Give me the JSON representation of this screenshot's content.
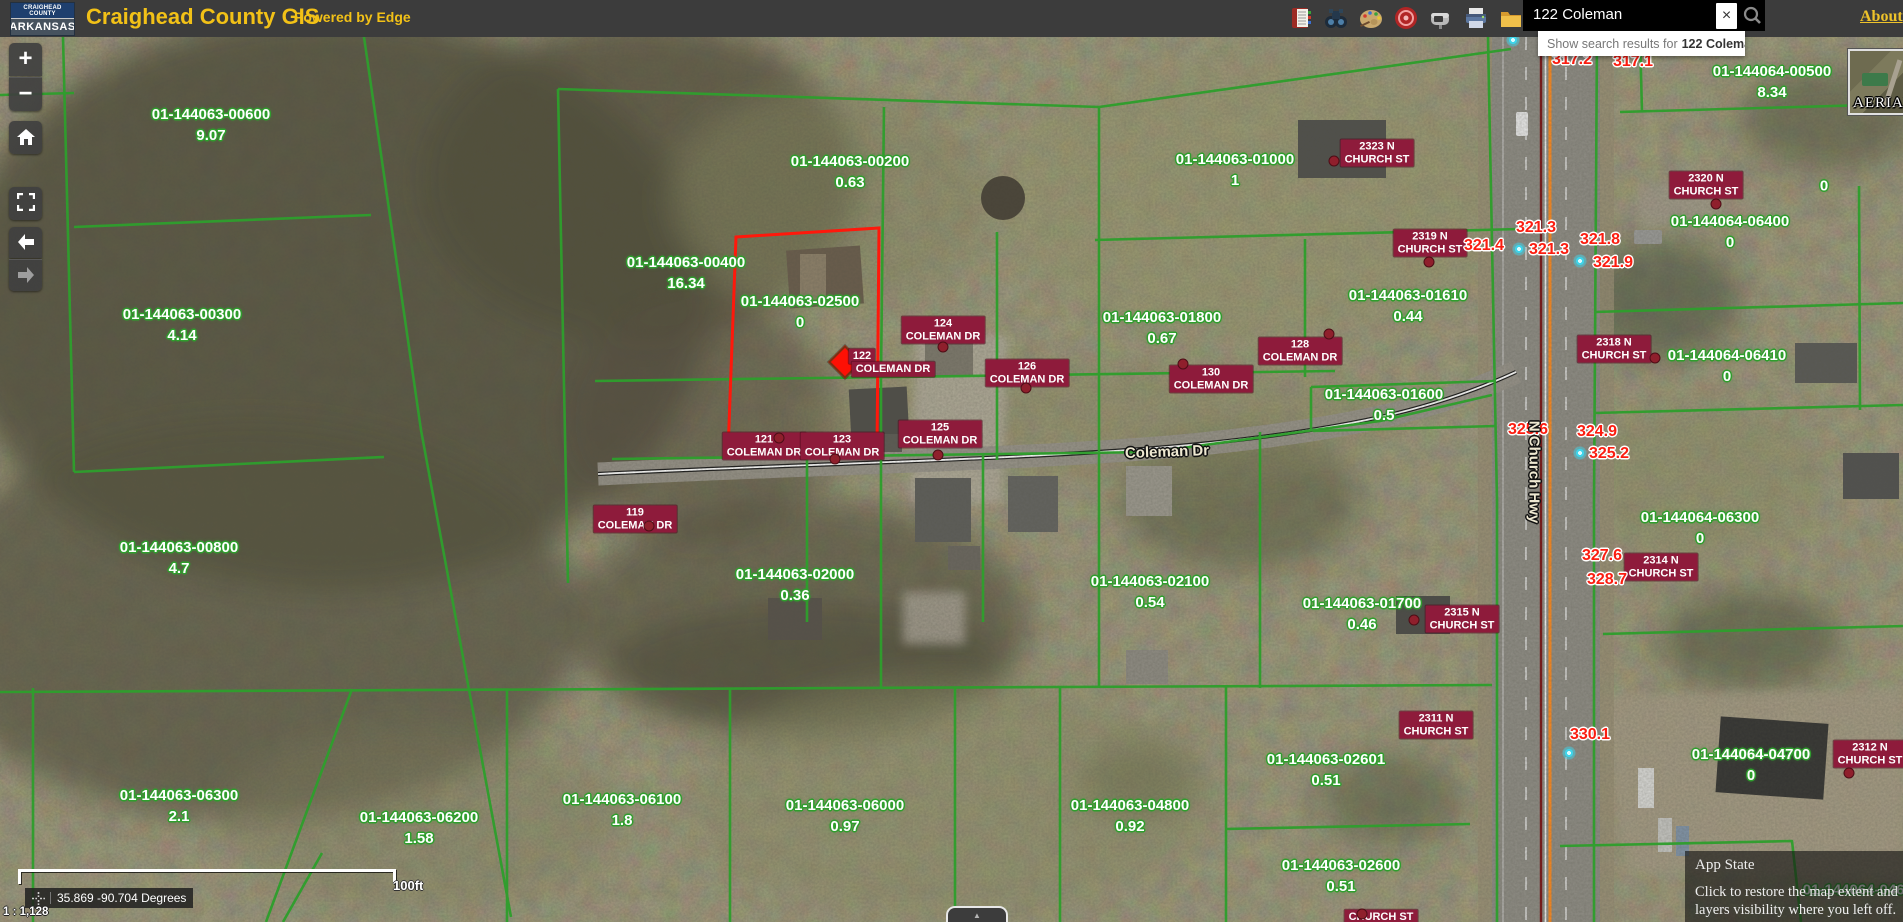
{
  "header": {
    "logo_line1": "CRAIGHEAD COUNTY",
    "logo_line2": "ARKANSAS",
    "title": "Craighead County GIS",
    "powered_by": "Powered by Edge",
    "about_link": "About",
    "toolbar_icons": [
      "address-book",
      "binoculars",
      "palette",
      "target",
      "mailbox",
      "printer",
      "folder"
    ],
    "search": {
      "value": "122 Coleman",
      "clear_label": "×",
      "suggestion_prefix": "Show search results for",
      "suggestion_query": "122 Coleman"
    }
  },
  "controls": {
    "zoom_in": "+",
    "zoom_out": "−"
  },
  "statusbar": {
    "scale_label": "100ft",
    "coordinates": "35.869 -90.704 Degrees",
    "scale_ratio": "1 : 1,128"
  },
  "basemap": {
    "label": "AERIAL"
  },
  "app_state": {
    "title": "App State",
    "close": "×",
    "body": "Click to restore the map extent and layers visibility where you left off."
  },
  "map": {
    "colors": {
      "parcel_line": "#2f9e2d",
      "selected_parcel": "#ff180b",
      "address_chip": "#8e1b3b",
      "elevation_text": "#fb1d10",
      "marker_cyan": "#3ed4ea"
    },
    "road_labels": [
      {
        "text": "Coleman Dr",
        "x": 1167,
        "y": 452,
        "rotate": -2
      },
      {
        "text": "N Church Hwy",
        "x": 1534,
        "y": 472,
        "rotate": 90
      }
    ],
    "parcel_labels": [
      {
        "id": "01-144063-00600",
        "area": "9.07",
        "x": 211,
        "y": 125
      },
      {
        "id": "01-144063-00300",
        "area": "4.14",
        "x": 182,
        "y": 325
      },
      {
        "id": "01-144063-00400",
        "area": "16.34",
        "x": 686,
        "y": 273
      },
      {
        "id": "01-144063-00200",
        "area": "0.63",
        "x": 850,
        "y": 172
      },
      {
        "id": "01-144063-02500",
        "area": "0",
        "x": 800,
        "y": 312
      },
      {
        "id": "01-144063-01000",
        "area": "1",
        "x": 1235,
        "y": 170
      },
      {
        "id": "01-144063-01800",
        "area": "0.67",
        "x": 1162,
        "y": 328
      },
      {
        "id": "01-144063-01610",
        "area": "0.44",
        "x": 1408,
        "y": 306
      },
      {
        "id": "01-144063-01600",
        "area": "0.5",
        "x": 1384,
        "y": 405
      },
      {
        "id": "01-144063-00800",
        "area": "4.7",
        "x": 179,
        "y": 558
      },
      {
        "id": "01-144063-02000",
        "area": "0.36",
        "x": 795,
        "y": 585
      },
      {
        "id": "01-144063-02100",
        "area": "0.54",
        "x": 1150,
        "y": 592
      },
      {
        "id": "01-144063-01700",
        "area": "0.46",
        "x": 1362,
        "y": 614
      },
      {
        "id": "01-144063-06300",
        "area": "2.1",
        "x": 179,
        "y": 806
      },
      {
        "id": "01-144063-06200",
        "area": "1.58",
        "x": 419,
        "y": 828
      },
      {
        "id": "01-144063-06100",
        "area": "1.8",
        "x": 622,
        "y": 810
      },
      {
        "id": "01-144063-06000",
        "area": "0.97",
        "x": 845,
        "y": 816
      },
      {
        "id": "01-144063-04800",
        "area": "0.92",
        "x": 1130,
        "y": 816
      },
      {
        "id": "01-144063-02601",
        "area": "0.51",
        "x": 1326,
        "y": 770
      },
      {
        "id": "01-144063-02600",
        "area": "0.51",
        "x": 1341,
        "y": 876
      },
      {
        "id": "01-144064-00500",
        "area": "8.34",
        "x": 1772,
        "y": 82
      },
      {
        "id": "01-144064-06400",
        "area": "0",
        "x": 1730,
        "y": 232
      },
      {
        "id": "01-144064-06410",
        "area": "0",
        "x": 1727,
        "y": 366
      },
      {
        "id": "01-144064-06300",
        "area": "0",
        "x": 1700,
        "y": 528
      },
      {
        "id": "01-144064-04700",
        "area": "0",
        "x": 1751,
        "y": 765
      },
      {
        "id": "01-144064-04600",
        "area": "",
        "x": 1862,
        "y": 890
      },
      {
        "id": "",
        "area": "0",
        "x": 1824,
        "y": 186
      }
    ],
    "address_labels": [
      {
        "lines": [
          "2323 N",
          "CHURCH ST"
        ],
        "x": 1377,
        "y": 153,
        "dot": [
          1334,
          161
        ]
      },
      {
        "lines": [
          "2319 N",
          "CHURCH ST"
        ],
        "x": 1430,
        "y": 243,
        "dot": [
          1429,
          262
        ]
      },
      {
        "lines": [
          "2320 N",
          "CHURCH ST"
        ],
        "x": 1706,
        "y": 185,
        "dot": [
          1716,
          204
        ]
      },
      {
        "lines": [
          "2318 N",
          "CHURCH ST"
        ],
        "x": 1614,
        "y": 349,
        "dot": [
          1655,
          358
        ]
      },
      {
        "lines": [
          "2314 N",
          "CHURCH ST"
        ],
        "x": 1661,
        "y": 567,
        "dot": null
      },
      {
        "lines": [
          "2315 N",
          "CHURCH ST"
        ],
        "x": 1462,
        "y": 619,
        "dot": [
          1414,
          620
        ]
      },
      {
        "lines": [
          "2311 N",
          "CHURCH ST"
        ],
        "x": 1436,
        "y": 725,
        "dot": null
      },
      {
        "lines": [
          "2312 N",
          "CHURCH ST"
        ],
        "x": 1870,
        "y": 754,
        "dot": [
          1849,
          773
        ]
      },
      {
        "lines": [
          "124",
          "COLEMAN DR"
        ],
        "x": 943,
        "y": 330,
        "dot": [
          943,
          347
        ]
      },
      {
        "lines": [
          "126",
          "COLEMAN DR"
        ],
        "x": 1027,
        "y": 373,
        "dot": [
          1026,
          388
        ]
      },
      {
        "lines": [
          "128",
          "COLEMAN DR"
        ],
        "x": 1300,
        "y": 351,
        "dot": [
          1329,
          334
        ]
      },
      {
        "lines": [
          "130",
          "COLEMAN DR"
        ],
        "x": 1211,
        "y": 379,
        "dot": [
          1183,
          364
        ]
      },
      {
        "lines": [
          "121",
          "COLEMAN DR"
        ],
        "x": 764,
        "y": 446,
        "dot": [
          779,
          438
        ]
      },
      {
        "lines": [
          "123",
          "COLEMAN DR"
        ],
        "x": 842,
        "y": 446,
        "dot": [
          835,
          459
        ]
      },
      {
        "lines": [
          "125",
          "COLEMAN DR"
        ],
        "x": 940,
        "y": 434,
        "dot": [
          938,
          455
        ]
      },
      {
        "lines": [
          "119",
          "COLEMAN DR"
        ],
        "x": 635,
        "y": 519,
        "dot": [
          649,
          526
        ]
      },
      {
        "lines": [
          "CHURCH ST"
        ],
        "x": 1381,
        "y": 917,
        "dot": [
          1362,
          914
        ]
      }
    ],
    "selected_address": {
      "number": "122",
      "street": "COLEMAN DR",
      "number_pos": [
        862,
        356
      ],
      "street_pos": [
        893,
        369
      ],
      "diamond": [
        845,
        362
      ]
    },
    "elevation_labels": [
      {
        "v": "317.2",
        "x": 1572,
        "y": 60
      },
      {
        "v": "317.1",
        "x": 1633,
        "y": 62
      },
      {
        "v": "321.3",
        "x": 1536,
        "y": 228
      },
      {
        "v": "321.4",
        "x": 1484,
        "y": 246
      },
      {
        "v": "321.3",
        "x": 1549,
        "y": 250
      },
      {
        "v": "321.8",
        "x": 1600,
        "y": 240
      },
      {
        "v": "321.9",
        "x": 1613,
        "y": 263
      },
      {
        "v": "325.6",
        "x": 1528,
        "y": 430
      },
      {
        "v": "324.9",
        "x": 1597,
        "y": 432
      },
      {
        "v": "325.2",
        "x": 1609,
        "y": 454
      },
      {
        "v": "327.6",
        "x": 1602,
        "y": 556
      },
      {
        "v": "328.7",
        "x": 1607,
        "y": 580
      },
      {
        "v": "330.1",
        "x": 1590,
        "y": 735
      }
    ],
    "cyan_markers": [
      [
        1513,
        40
      ],
      [
        1519,
        249
      ],
      [
        1580,
        261
      ],
      [
        1580,
        453
      ],
      [
        1569,
        753
      ]
    ]
  }
}
